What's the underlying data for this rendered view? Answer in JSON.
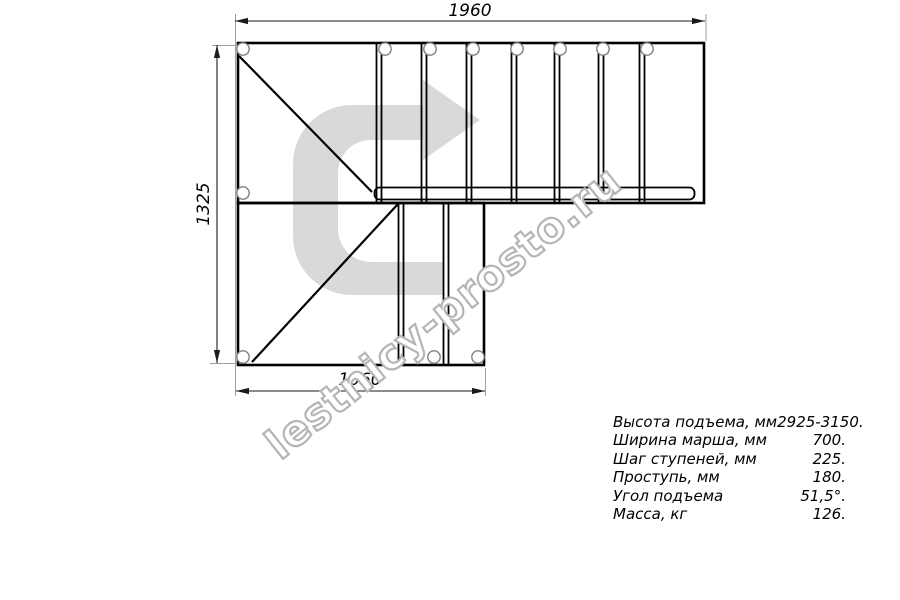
{
  "page": {
    "background": "#ffffff"
  },
  "drawing": {
    "title_hint": "L-shaped staircase plan view",
    "dimensions": {
      "top": "1960",
      "left": "1325",
      "bottom": "1060"
    },
    "watermark_text": "lestnicy-prosto.ru",
    "colors": {
      "line": "#000000",
      "dim_line": "#1a1a1a",
      "extension_line": "#9e9e9e",
      "arrow_fill": "#d9d9d9",
      "watermark_outline": "#b5b5b5",
      "hole_stroke": "#808080"
    }
  },
  "specs": {
    "rows": [
      {
        "label": "Высота подъема, мм",
        "value": "2925-3150."
      },
      {
        "label": "Ширина марша, мм",
        "value": "700."
      },
      {
        "label": "Шаг ступеней, мм",
        "value": "225."
      },
      {
        "label": "Проступь, мм",
        "value": "180."
      },
      {
        "label": "Угол подъема",
        "value": "51,5°."
      },
      {
        "label": "Масса, кг",
        "value": "126."
      }
    ]
  }
}
